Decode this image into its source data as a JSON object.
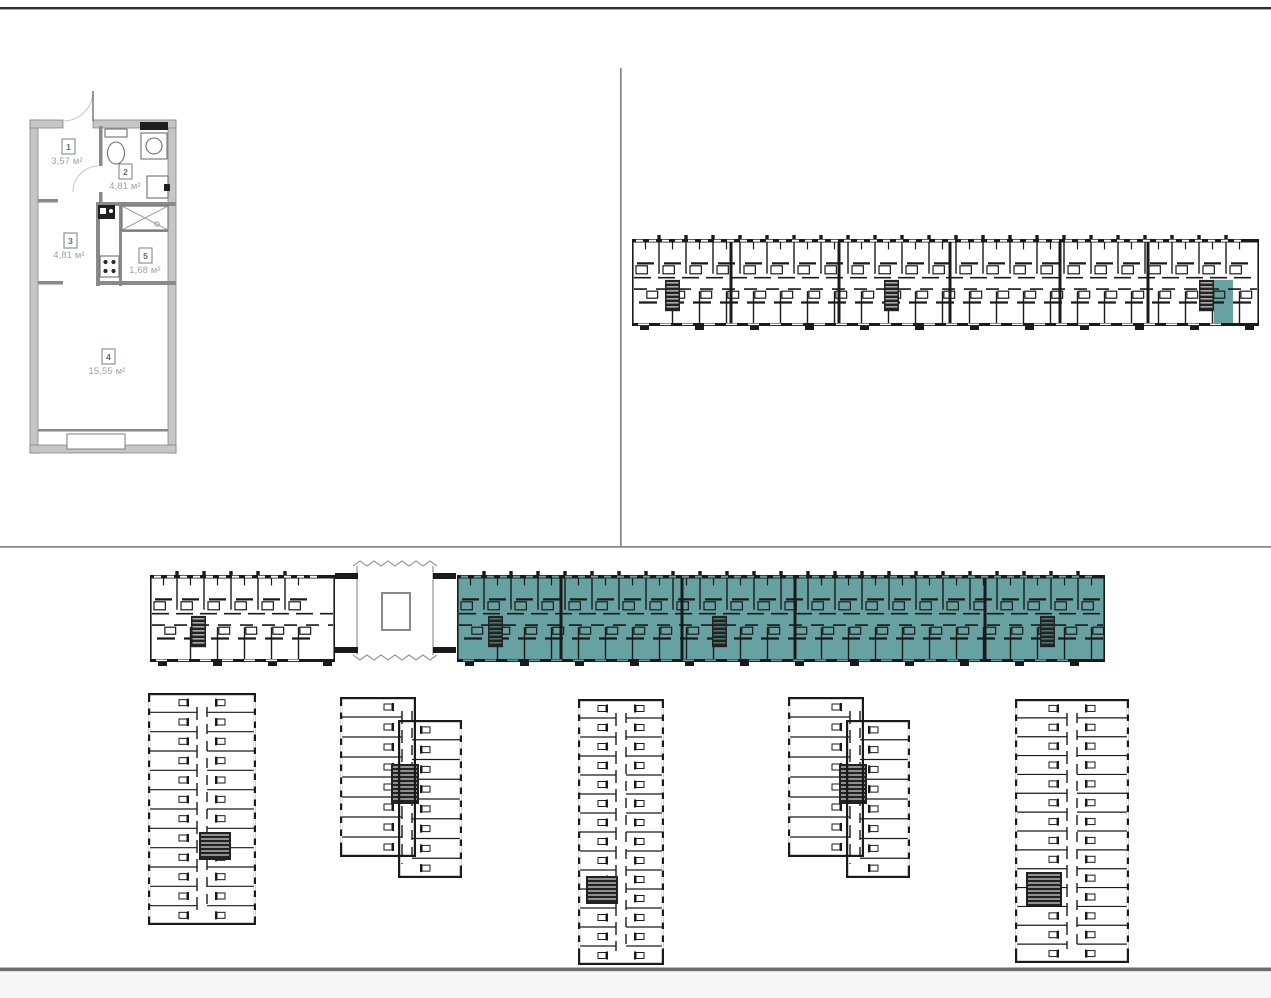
{
  "page": {
    "description": "Real-estate floor plan viewer: apartment plan, building floor plan with highlighted unit, and site plan with highlighted building section"
  },
  "colors": {
    "highlight_teal": "#68a1a2",
    "wall_dark": "#1a1a1a",
    "wall_gray": "#c6c6c6",
    "inner_wall_gray": "#8a8a8a",
    "divider_gray": "#868686",
    "top_border_dark": "#2f2f2f",
    "bottom_border_gray": "#6e6e6e",
    "footer_bg": "#f6f6f6",
    "label_text_gray": "#9ba1a1",
    "plan_bg": "#ffffff"
  },
  "apartment_plan": {
    "rooms": [
      {
        "number": "1",
        "area": "3,57 м²"
      },
      {
        "number": "2",
        "area": "4,81 м²"
      },
      {
        "number": "3",
        "area": "4,81 м²"
      },
      {
        "number": "5",
        "area": "1,68 м²"
      },
      {
        "number": "4",
        "area": "15,55 м²"
      }
    ]
  },
  "building_floor_plan": {
    "highlighted_units": 1
  },
  "site_plan": {
    "highlighted_sections": 1
  }
}
